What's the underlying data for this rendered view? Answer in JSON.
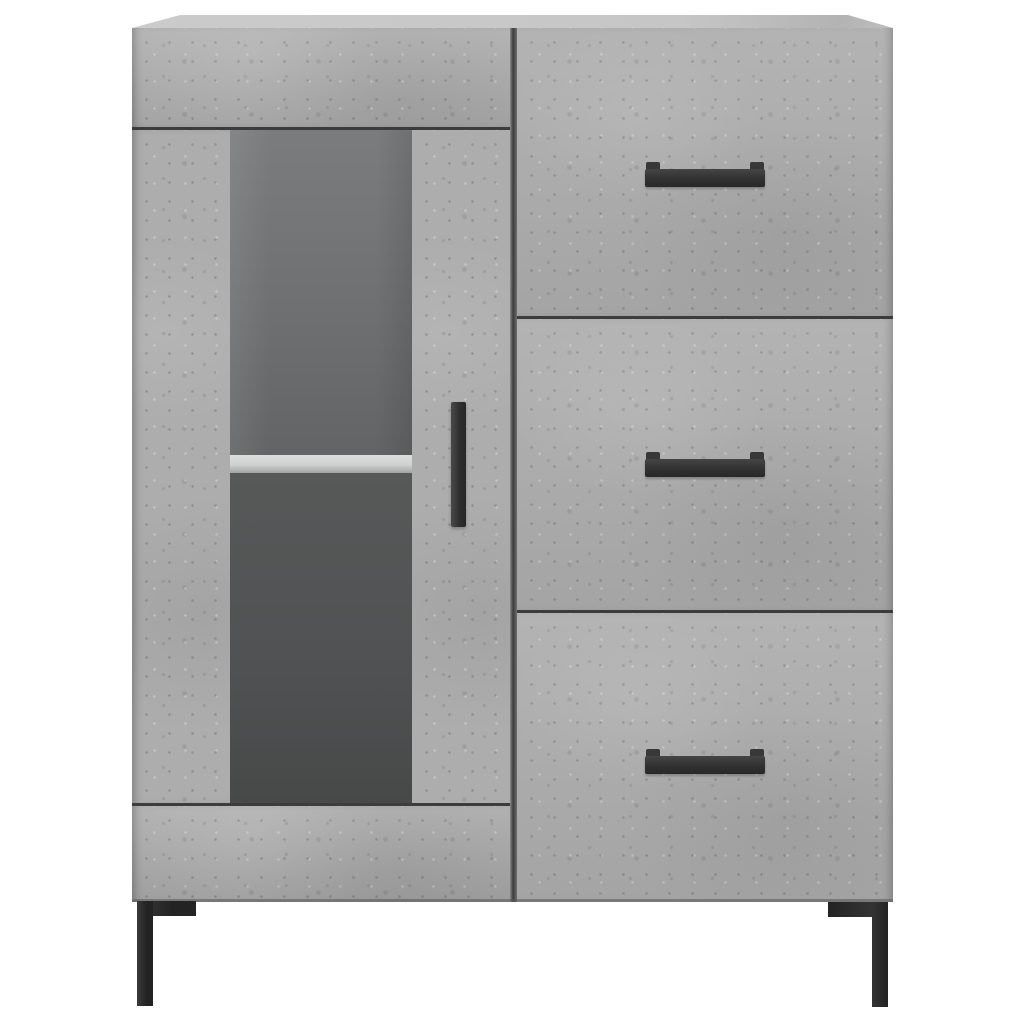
{
  "scene": {
    "description": "Product photo on a plain white background: a concrete-grey sideboard cabinet with a glass-panel door on the left (one interior shelf visible), three drawers on the right with black horizontal bar handles, a black vertical bar handle on the door, and two visible black L-shaped metal legs.",
    "background_color": "#ffffff"
  },
  "colors": {
    "background": "#ffffff",
    "concrete_base": "#adadad",
    "top_surface": "#cbcbcb",
    "seam_dark": "#3c3c3c",
    "glass_top": "#7a7c7d",
    "glass_bottom": "#474949",
    "shelf_light": "#cfd1d1",
    "handle_black": "#303030",
    "leg_black": "#232323"
  },
  "cabinet": {
    "finish": "concrete grey",
    "left_section": {
      "parts": [
        "top-rail",
        "glass-door",
        "interior-shelf",
        "bottom-rail"
      ],
      "door_handle": "vertical black bar",
      "glass_panel": "dark tinted, interior visible with one light shelf"
    },
    "right_section": {
      "drawers": [
        {
          "position": "top",
          "handle": "horizontal black bar"
        },
        {
          "position": "middle",
          "handle": "horizontal black bar"
        },
        {
          "position": "bottom",
          "handle": "horizontal black bar"
        }
      ]
    },
    "legs": {
      "visible_count": 2,
      "style": "black L-shaped metal corner legs"
    }
  }
}
